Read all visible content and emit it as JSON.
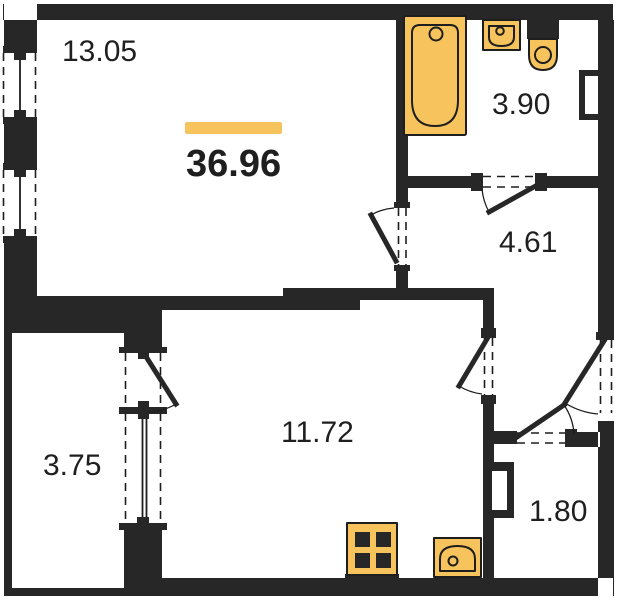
{
  "colors": {
    "accent": "#F7C35C",
    "wall": "#272727",
    "line": "#1E1E1E",
    "text": "#1F1F1F",
    "background": "#FFFFFF"
  },
  "plan": {
    "type": "apartment-floor-plan",
    "total_area": "36.96",
    "rooms": [
      {
        "name": "living-room",
        "area": "13.05"
      },
      {
        "name": "bathroom",
        "area": "3.90"
      },
      {
        "name": "hallway",
        "area": "4.61"
      },
      {
        "name": "kitchen-living-room",
        "area": "11.72"
      },
      {
        "name": "balcony",
        "area": "3.75"
      },
      {
        "name": "storage",
        "area": "1.80"
      }
    ],
    "fixtures": [
      "bathtub",
      "washbasin",
      "toilet",
      "stove",
      "kitchen-sink"
    ]
  }
}
